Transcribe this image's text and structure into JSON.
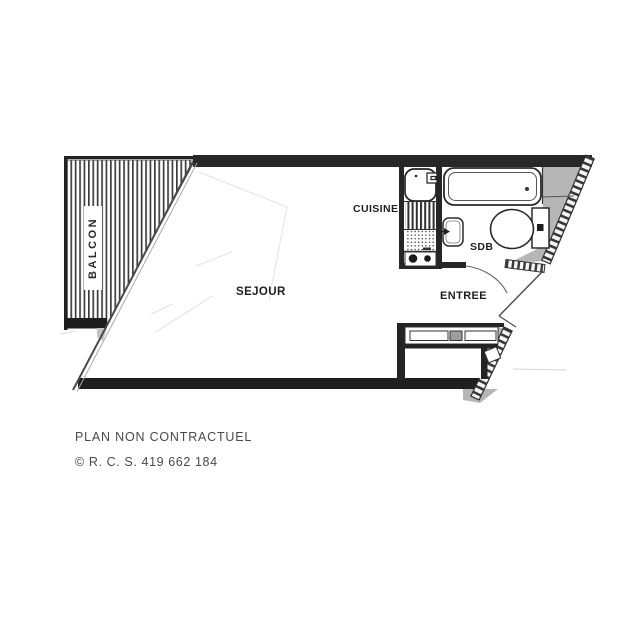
{
  "rooms": {
    "balcony": {
      "label": "BALCON"
    },
    "living_room": {
      "label": "SEJOUR"
    },
    "kitchen": {
      "label": "CUISINE"
    },
    "bathroom": {
      "label": "SDB"
    },
    "entrance": {
      "label": "ENTREE"
    }
  },
  "footer": {
    "disclaimer": "PLAN NON CONTRACTUEL",
    "registration": "© R. C. S. 419 662 184"
  },
  "fixtures": [
    "bathtub",
    "toilet",
    "washbasin",
    "kitchen-sink",
    "drainer",
    "stove-two-burners",
    "closet",
    "entry-door",
    "bathroom-door",
    "balcony-decking"
  ],
  "colors": {
    "wall": "#242424",
    "shade": "#b6b6b6",
    "faint_line": "#dfdfdf",
    "label_text": "#1f1f1f",
    "footer_text": "#4a4a4a",
    "background": "#ffffff"
  }
}
